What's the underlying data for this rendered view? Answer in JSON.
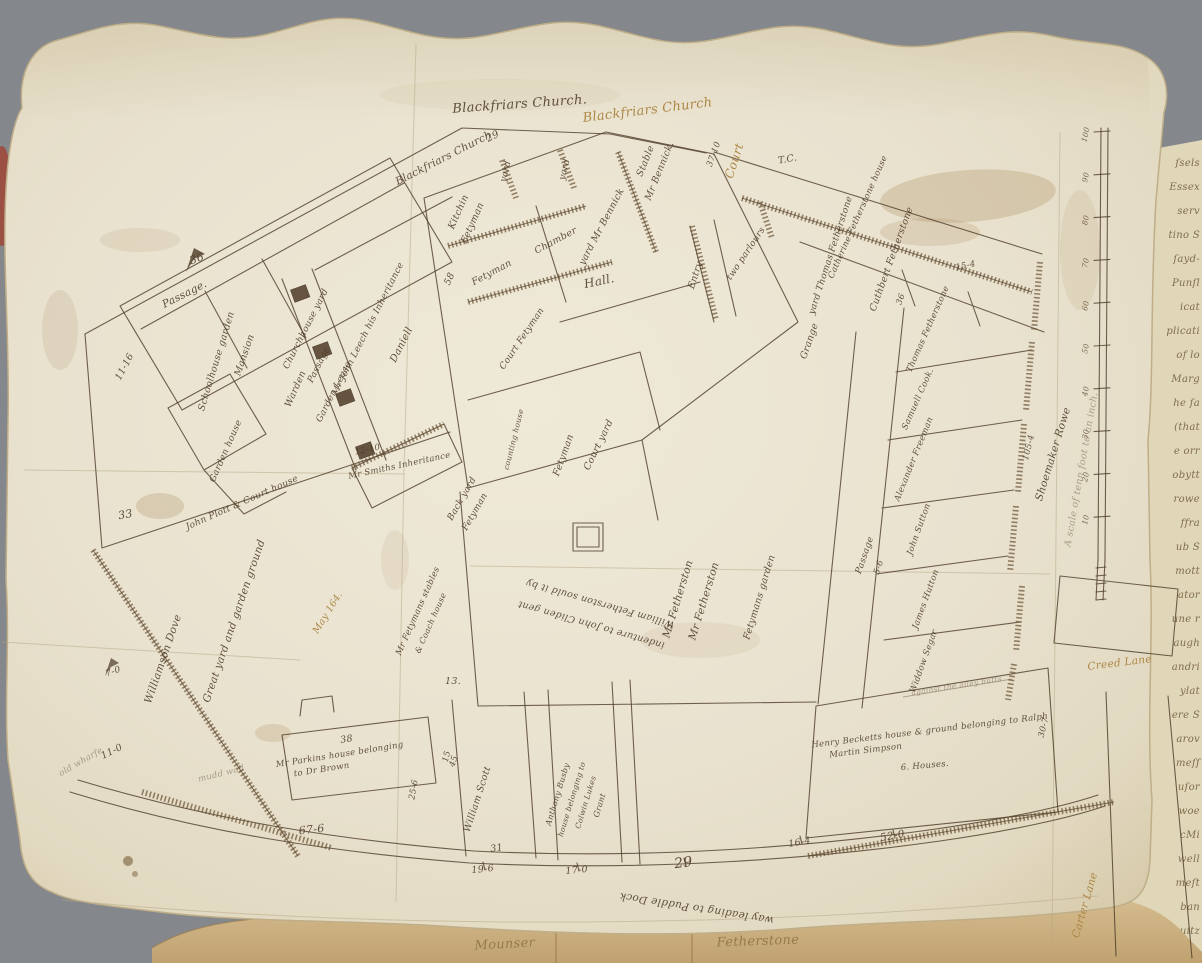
{
  "palette": {
    "background_gray": "#84878b",
    "parchment": "#eae3d0",
    "parchment_edge": "#bfae88",
    "ink": "#4c3b27",
    "ochre_ink": "#a8813c",
    "manuscript_page": "#e0d6b8",
    "leather_strip": "#c9ad7e",
    "wax_fragment_red": "#9e4a3c"
  },
  "map": {
    "labels": [
      {
        "t": "Blackfriars Church.",
        "x": 520,
        "y": 108,
        "r": -4,
        "s": 13,
        "n": "street-label-blackfriars-church-ink"
      },
      {
        "t": "Blackfriars Church",
        "x": 648,
        "y": 114,
        "r": -7,
        "s": 13,
        "c": "ochre",
        "n": "street-label-blackfriars-church-ochre"
      },
      {
        "t": "Blackfriars Church",
        "x": 445,
        "y": 161,
        "r": -27,
        "s": 10.5,
        "n": "boundary-label-blackfriars-church"
      },
      {
        "t": "29",
        "x": 494,
        "y": 139,
        "r": -27,
        "s": 10
      },
      {
        "t": "Court",
        "x": 738,
        "y": 162,
        "r": -72,
        "s": 12,
        "c": "ochre",
        "n": "court-label-ochre"
      },
      {
        "t": "37-10",
        "x": 716,
        "y": 155,
        "r": -70,
        "s": 8.5
      },
      {
        "t": "T.C.",
        "x": 788,
        "y": 162,
        "r": -10,
        "s": 9.5
      },
      {
        "t": "36",
        "x": 198,
        "y": 262,
        "r": -20,
        "s": 11
      },
      {
        "t": "Passage.",
        "x": 186,
        "y": 297,
        "r": -27,
        "s": 10.5
      },
      {
        "t": "Schoolhouse garden",
        "x": 219,
        "y": 362,
        "r": -73,
        "s": 9.5
      },
      {
        "t": "Mansion",
        "x": 247,
        "y": 356,
        "r": -71,
        "s": 9.5
      },
      {
        "t": "Warden",
        "x": 298,
        "y": 390,
        "r": -66,
        "s": 9.5
      },
      {
        "t": "11-16",
        "x": 127,
        "y": 368,
        "r": -62,
        "s": 9.5
      },
      {
        "t": "Garden house",
        "x": 228,
        "y": 452,
        "r": -66,
        "s": 9
      },
      {
        "t": "33",
        "x": 126,
        "y": 518,
        "r": -10,
        "s": 11
      },
      {
        "t": "Churchhouse yard",
        "x": 308,
        "y": 330,
        "r": -63,
        "s": 9
      },
      {
        "t": "Passage",
        "x": 321,
        "y": 366,
        "r": -63,
        "s": 9
      },
      {
        "t": "Garden Lease",
        "x": 336,
        "y": 393,
        "r": -63,
        "s": 9
      },
      {
        "t": "Mr John Leech his Inheritance",
        "x": 370,
        "y": 330,
        "r": -63,
        "s": 9
      },
      {
        "t": "Daniell",
        "x": 404,
        "y": 346,
        "r": -63,
        "s": 10
      },
      {
        "t": "Mr Smiths Inheritance",
        "x": 400,
        "y": 468,
        "r": -12,
        "s": 8.5
      },
      {
        "t": "12-10",
        "x": 368,
        "y": 452,
        "r": -12,
        "s": 8.5
      },
      {
        "t": "58",
        "x": 452,
        "y": 280,
        "r": -65,
        "s": 9.5
      },
      {
        "t": "Kitchin",
        "x": 461,
        "y": 213,
        "r": -66,
        "s": 9.5
      },
      {
        "t": "Fetyman",
        "x": 475,
        "y": 224,
        "r": -66,
        "s": 9.5
      },
      {
        "t": "yard",
        "x": 508,
        "y": 172,
        "r": -76,
        "s": 9
      },
      {
        "t": "yard",
        "x": 567,
        "y": 170,
        "r": -76,
        "s": 9
      },
      {
        "t": "Fetyman",
        "x": 493,
        "y": 275,
        "r": -28,
        "s": 9.5
      },
      {
        "t": "Chamber",
        "x": 557,
        "y": 243,
        "r": -28,
        "s": 9.5
      },
      {
        "t": "Hall.",
        "x": 600,
        "y": 285,
        "r": -12,
        "s": 12,
        "n": "room-label-hall"
      },
      {
        "t": "Stable",
        "x": 648,
        "y": 162,
        "r": -68,
        "s": 9.5
      },
      {
        "t": "Mr Bennick.",
        "x": 662,
        "y": 172,
        "r": -68,
        "s": 9.5
      },
      {
        "t": "yard Mr Bennick",
        "x": 604,
        "y": 228,
        "r": -62,
        "s": 9.5
      },
      {
        "t": "Entry",
        "x": 698,
        "y": 276,
        "r": -72,
        "s": 9.5
      },
      {
        "t": "two parlours",
        "x": 748,
        "y": 255,
        "r": -56,
        "s": 9
      },
      {
        "t": "Catherine Fetherstone house",
        "x": 860,
        "y": 218,
        "r": -66,
        "s": 8.5
      },
      {
        "t": "yard Thomas Fetherstone",
        "x": 833,
        "y": 256,
        "r": -72,
        "s": 9
      },
      {
        "t": "Cuthbert Fetherstone",
        "x": 894,
        "y": 260,
        "r": -70,
        "s": 9.5
      },
      {
        "t": "36",
        "x": 903,
        "y": 300,
        "r": -70,
        "s": 8.5
      },
      {
        "t": "15-4",
        "x": 966,
        "y": 268,
        "r": -12,
        "s": 8.5
      },
      {
        "t": "Grange",
        "x": 812,
        "y": 342,
        "r": -71,
        "s": 9.5
      },
      {
        "t": "counting house",
        "x": 516,
        "y": 440,
        "r": -76,
        "s": 7.5
      },
      {
        "t": "Fetyman",
        "x": 566,
        "y": 456,
        "r": -70,
        "s": 9.5
      },
      {
        "t": "Court yard",
        "x": 601,
        "y": 446,
        "r": -64,
        "s": 9.5
      },
      {
        "t": "Court Fetyman",
        "x": 524,
        "y": 340,
        "r": -56,
        "s": 9
      },
      {
        "t": "Back yard",
        "x": 464,
        "y": 500,
        "r": -60,
        "s": 9
      },
      {
        "t": "Fetyman",
        "x": 477,
        "y": 513,
        "r": -60,
        "s": 9
      },
      {
        "t": "Mr Fetherston",
        "x": 681,
        "y": 600,
        "r": -73,
        "s": 10.5,
        "n": "plot-label-mr-fetherston"
      },
      {
        "t": "Mr Fetherston",
        "x": 707,
        "y": 602,
        "r": -73,
        "s": 10.5
      },
      {
        "t": "Fetymans garden",
        "x": 762,
        "y": 598,
        "r": -73,
        "s": 9.5
      },
      {
        "t": "William Fetherston sould it by",
        "x": 601,
        "y": 601,
        "r": 196,
        "s": 9.5,
        "n": "memorandum-line-1"
      },
      {
        "t": "indenture to John Cliden gent",
        "x": 592,
        "y": 622,
        "r": 196,
        "s": 9.5,
        "n": "memorandum-line-2"
      },
      {
        "t": "13.",
        "x": 453,
        "y": 684,
        "r": 0,
        "s": 9.5
      },
      {
        "t": "Mr Fetymans stables",
        "x": 420,
        "y": 612,
        "r": -66,
        "s": 8.5
      },
      {
        "t": "& Coach house",
        "x": 433,
        "y": 624,
        "r": -66,
        "s": 8
      },
      {
        "t": "John Plott & Court house",
        "x": 243,
        "y": 505,
        "r": -24,
        "s": 9
      },
      {
        "t": "Great yard and garden ground",
        "x": 237,
        "y": 622,
        "r": -71,
        "s": 10.5,
        "n": "plot-label-great-yard"
      },
      {
        "t": "Williamson Dove",
        "x": 166,
        "y": 660,
        "r": -71,
        "s": 10.5
      },
      {
        "t": "7-0",
        "x": 114,
        "y": 674,
        "r": -20,
        "s": 9
      },
      {
        "t": "May 164.",
        "x": 330,
        "y": 614,
        "r": -58,
        "s": 9.5,
        "c": "ochre"
      },
      {
        "t": "Mr Parkins house belonging",
        "x": 340,
        "y": 757,
        "r": -9,
        "s": 8.5
      },
      {
        "t": "to Dr Brown",
        "x": 322,
        "y": 772,
        "r": -9,
        "s": 8.5
      },
      {
        "t": "38",
        "x": 347,
        "y": 742,
        "r": -9,
        "s": 9.5
      },
      {
        "t": "25-6",
        "x": 416,
        "y": 790,
        "r": -80,
        "s": 8.5
      },
      {
        "t": "15",
        "x": 449,
        "y": 757,
        "r": -76,
        "s": 8.5
      },
      {
        "t": "11-0",
        "x": 113,
        "y": 754,
        "r": -26,
        "s": 9.5
      },
      {
        "t": "mudd wall",
        "x": 222,
        "y": 776,
        "r": -14,
        "s": 8.5,
        "c": "faint"
      },
      {
        "t": "old wharfe",
        "x": 82,
        "y": 764,
        "r": -30,
        "s": 8.5,
        "c": "faint"
      },
      {
        "t": "67-6",
        "x": 312,
        "y": 833,
        "r": -6,
        "s": 11
      },
      {
        "t": "William Scott",
        "x": 480,
        "y": 800,
        "r": -72,
        "s": 9.5
      },
      {
        "t": "45",
        "x": 456,
        "y": 762,
        "r": -72,
        "s": 8.5
      },
      {
        "t": "31",
        "x": 497,
        "y": 851,
        "r": -8,
        "s": 9.5
      },
      {
        "t": "Anthony Busby",
        "x": 560,
        "y": 795,
        "r": -73,
        "s": 8
      },
      {
        "t": "house belonging to",
        "x": 574,
        "y": 800,
        "r": -73,
        "s": 7.5
      },
      {
        "t": "Colwin Lukes",
        "x": 588,
        "y": 803,
        "r": -73,
        "s": 7.5
      },
      {
        "t": "Grant",
        "x": 602,
        "y": 806,
        "r": -73,
        "s": 8
      },
      {
        "t": "19-6",
        "x": 483,
        "y": 872,
        "r": -6,
        "s": 9.5
      },
      {
        "t": "17-0",
        "x": 577,
        "y": 873,
        "r": -6,
        "s": 9.5
      },
      {
        "t": "29",
        "x": 684,
        "y": 867,
        "r": -8,
        "s": 14
      },
      {
        "t": "16-4",
        "x": 800,
        "y": 845,
        "r": -10,
        "s": 9.5
      },
      {
        "t": "52-0",
        "x": 893,
        "y": 839,
        "r": -10,
        "s": 10.5
      },
      {
        "t": "way leading to Puddle Dock",
        "x": 697,
        "y": 905,
        "r": 189,
        "s": 10.5,
        "n": "street-label-puddle-dock"
      },
      {
        "t": "Henry Becketts house & ground belonging to Ralph",
        "x": 930,
        "y": 733,
        "r": -7,
        "s": 8.5
      },
      {
        "t": "Martin Simpson",
        "x": 866,
        "y": 753,
        "r": -7,
        "s": 8.5
      },
      {
        "t": "6. Houses.",
        "x": 925,
        "y": 768,
        "r": -5,
        "s": 8.5
      },
      {
        "t": "against the alley butts",
        "x": 957,
        "y": 688,
        "r": -9,
        "s": 7.5,
        "c": "faint"
      },
      {
        "t": "30-7",
        "x": 1046,
        "y": 728,
        "r": -76,
        "s": 8.5
      },
      {
        "t": "Thomas Fetherstone",
        "x": 930,
        "y": 330,
        "r": -66,
        "s": 8.5,
        "n": "tenant-thomas-fetherstone"
      },
      {
        "t": "Samuell Cook.",
        "x": 920,
        "y": 400,
        "r": -66,
        "s": 8.5,
        "n": "tenant-samuell-cook"
      },
      {
        "t": "Alexander Freeman",
        "x": 916,
        "y": 460,
        "r": -68,
        "s": 8.5,
        "n": "tenant-alexander-freeman"
      },
      {
        "t": "John Sutton",
        "x": 921,
        "y": 530,
        "r": -70,
        "s": 8.5,
        "n": "tenant-john-sutton"
      },
      {
        "t": "James Hutton",
        "x": 928,
        "y": 600,
        "r": -70,
        "s": 8.5,
        "n": "tenant-james-hutton"
      },
      {
        "t": "Widdow Segar",
        "x": 926,
        "y": 662,
        "r": -70,
        "s": 8.5,
        "n": "tenant-widdow-segar"
      },
      {
        "t": "Passage",
        "x": 867,
        "y": 556,
        "r": -71,
        "s": 9
      },
      {
        "t": "5-6",
        "x": 881,
        "y": 568,
        "r": -71,
        "s": 8.5
      },
      {
        "t": "Shoemaker Rowe",
        "x": 1056,
        "y": 455,
        "r": -73,
        "s": 10.5,
        "n": "street-label-shoemaker-rowe"
      },
      {
        "t": "105-4",
        "x": 1031,
        "y": 448,
        "r": -76,
        "s": 8.5
      },
      {
        "t": "Creed Lane",
        "x": 1120,
        "y": 666,
        "r": -7,
        "s": 10.5,
        "c": "ochre",
        "n": "street-label-creed-lane"
      },
      {
        "t": "Carter Lane",
        "x": 1088,
        "y": 906,
        "r": -74,
        "s": 10.5,
        "c": "ochre",
        "n": "street-label-carter-lane"
      },
      {
        "t": "Mounser",
        "x": 505,
        "y": 948,
        "r": -3,
        "s": 13,
        "c": "leather-text",
        "n": "endorsement-left"
      },
      {
        "t": "Fetherstone",
        "x": 758,
        "y": 945,
        "r": -2,
        "s": 13,
        "c": "leather-text",
        "n": "endorsement-right"
      }
    ]
  },
  "scale_bar": {
    "caption": "A scale of tenn foot to an inch.",
    "ticks": [
      "100",
      "90",
      "80",
      "70",
      "60",
      "50",
      "40",
      "30",
      "20",
      "10"
    ]
  },
  "manuscript": {
    "lines": [
      "ſsels",
      "Essex",
      "serv",
      "tino S",
      "ſayd-",
      "Punſl",
      "icat",
      "plicati",
      "of lo",
      "Marg",
      "he ſa",
      "(that",
      "e orr",
      "obytt",
      "rowe",
      "ffra",
      "ub S",
      "mott",
      "ator",
      "une r",
      "augh",
      "andri",
      "ylat",
      "ere S",
      "arov",
      "meſſ",
      "uſor",
      "woe",
      "cMi",
      "well",
      "meſt",
      "ban",
      "uitz"
    ]
  }
}
